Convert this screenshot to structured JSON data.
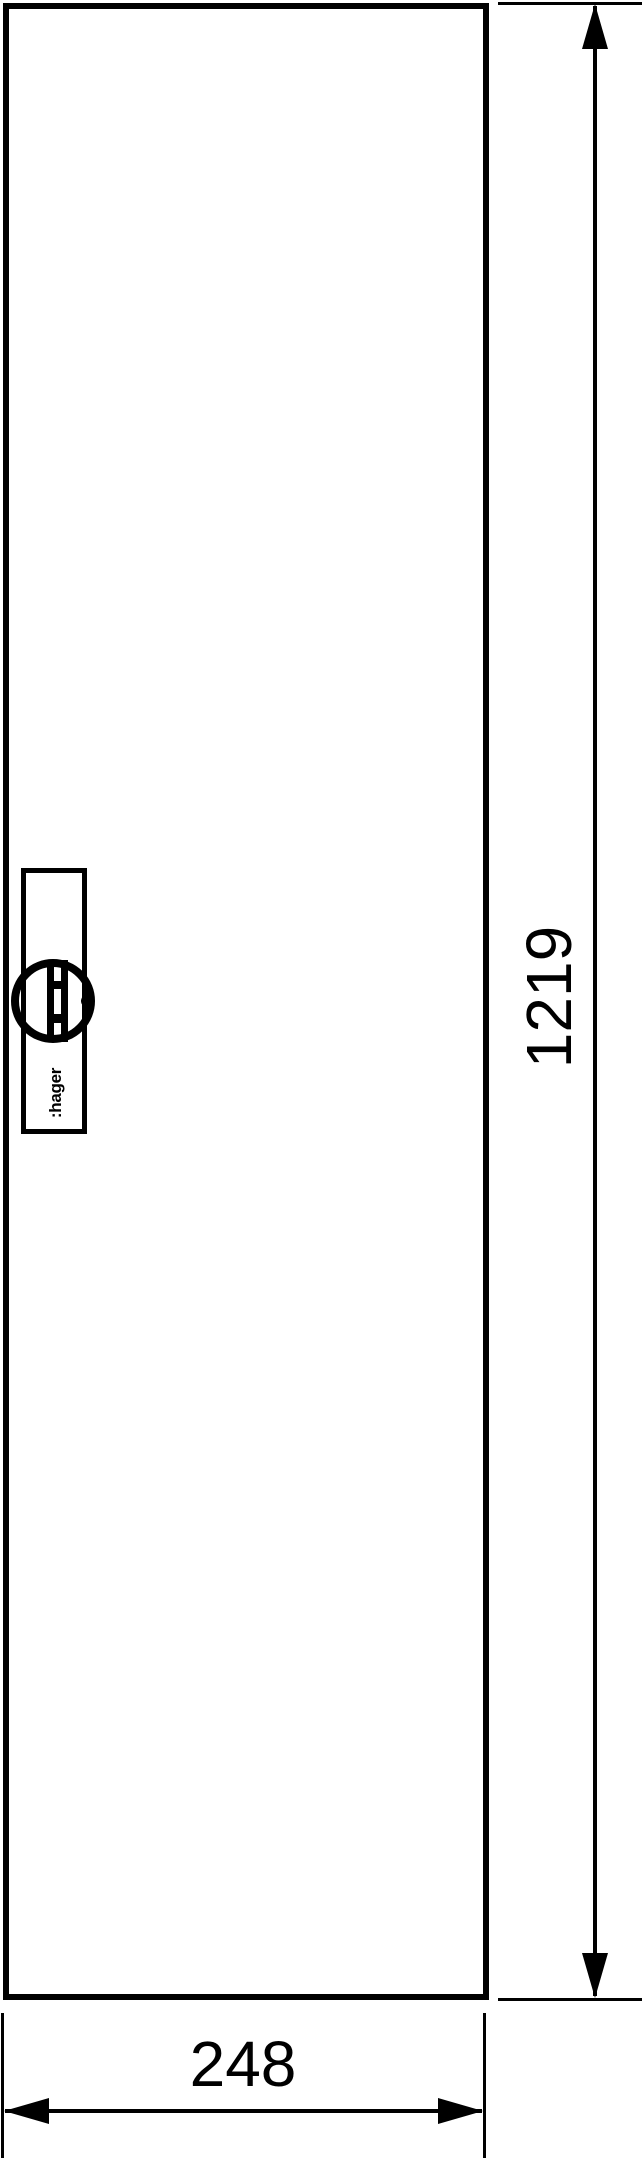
{
  "drawing": {
    "ink_color": "#000000",
    "background_color": "#ffffff",
    "brand_logo": ":hager",
    "height_dimension": {
      "value": "1219"
    },
    "width_dimension": {
      "value": "248"
    }
  }
}
